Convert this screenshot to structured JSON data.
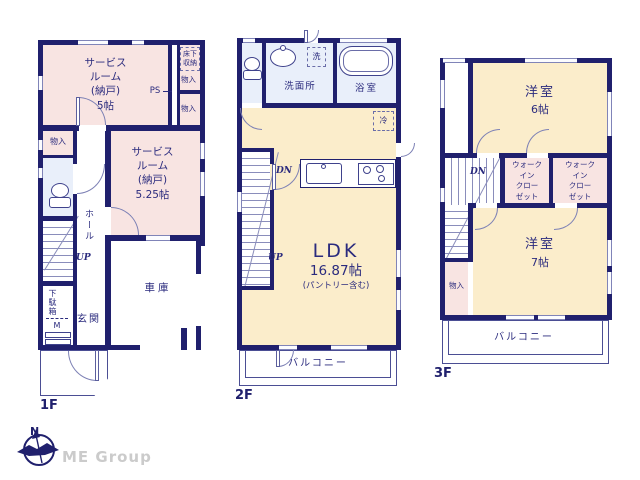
{
  "colors": {
    "wall": "#20206d",
    "room_pink": "#f8e4e2",
    "room_cream": "#fbedcb",
    "wet_blue": "#e9effa",
    "line": "#4b4e94",
    "text": "#2b2b7e",
    "logo_gray": "#cbcbcb"
  },
  "icons": {
    "compass": "compass-icon",
    "toilet": "toilet-icon",
    "bathtub": "bathtub-icon",
    "sink": "sink-icon",
    "stove": "stove-icon"
  },
  "floor1": {
    "floor_label": "1F",
    "service_room_1": "サービス\nルーム\n(納戸)\n5帖",
    "underfloor_storage": "床下\n収納",
    "closet_a": "物入",
    "closet_b": "物入",
    "ps_label": "PS",
    "service_room_2": "サービス\nルーム\n(納戸)\n5.25帖",
    "closet_left": "物入",
    "hall": "ホール",
    "up_label": "UP",
    "shoe_cabinet": "下駄箱",
    "shoe_cabinet_m": "M",
    "entrance": "玄関",
    "garage": "車庫"
  },
  "floor2": {
    "floor_label": "2F",
    "washroom": "洗面所",
    "washer": "洗",
    "bathroom": "浴室",
    "fridge": "冷",
    "dn_label": "DN",
    "up_label": "UP",
    "ldk": "LDK",
    "ldk_size": "16.87帖",
    "ldk_note": "(パントリー含む)",
    "balcony": "バルコニー"
  },
  "floor3": {
    "floor_label": "3F",
    "western_room_6": "洋室",
    "western_room_6_size": "6帖",
    "dn_label": "DN",
    "walk_in_closet_1": "ウォーク\nイン\nクロー\nゼット",
    "walk_in_closet_2": "ウォーク\nイン\nクロー\nゼット",
    "western_room_7": "洋室",
    "western_room_7_size": "7帖",
    "closet": "物入",
    "balcony": "バルコニー"
  },
  "footer": {
    "compass_n": "N",
    "logo_text": "ME Group"
  }
}
